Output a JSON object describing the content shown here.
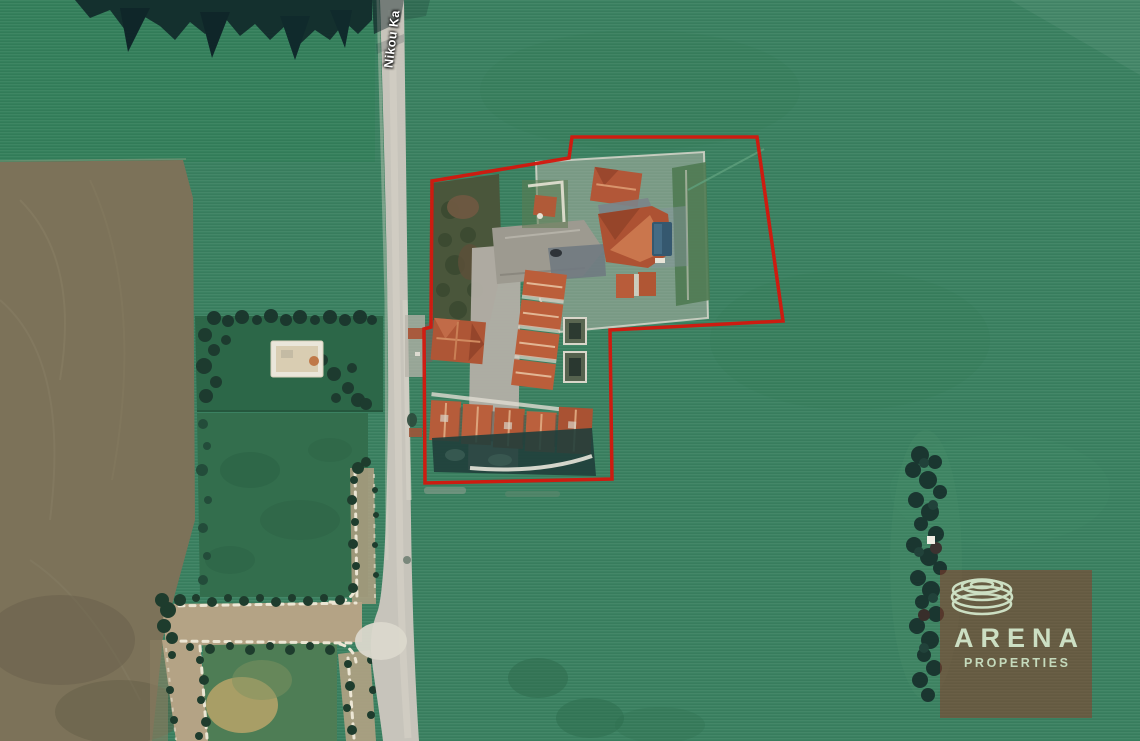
{
  "map": {
    "street_label": "Nikou Ka",
    "boundary": {
      "color": "#d2180e",
      "stroke_width": 3.5,
      "points": "432,181 569,158 572,137 757,137 783,321 610,330 612,479 425,483 424,329 431,327"
    }
  },
  "watermark": {
    "brand": "ARENA",
    "tagline": "PROPERTIES",
    "panel_color": "rgba(141,59,41,0.52)",
    "text_color": "#ccdfc3"
  },
  "palette": {
    "field_green": "#3b8161",
    "dark_trees": "#16312c",
    "plowed_field": "#7c7259",
    "road_gray": "#c7c4bb",
    "dirt_track_tan": "#b4a385",
    "roof_terracotta": "#b2593a",
    "pool_blue": "#35586f"
  }
}
